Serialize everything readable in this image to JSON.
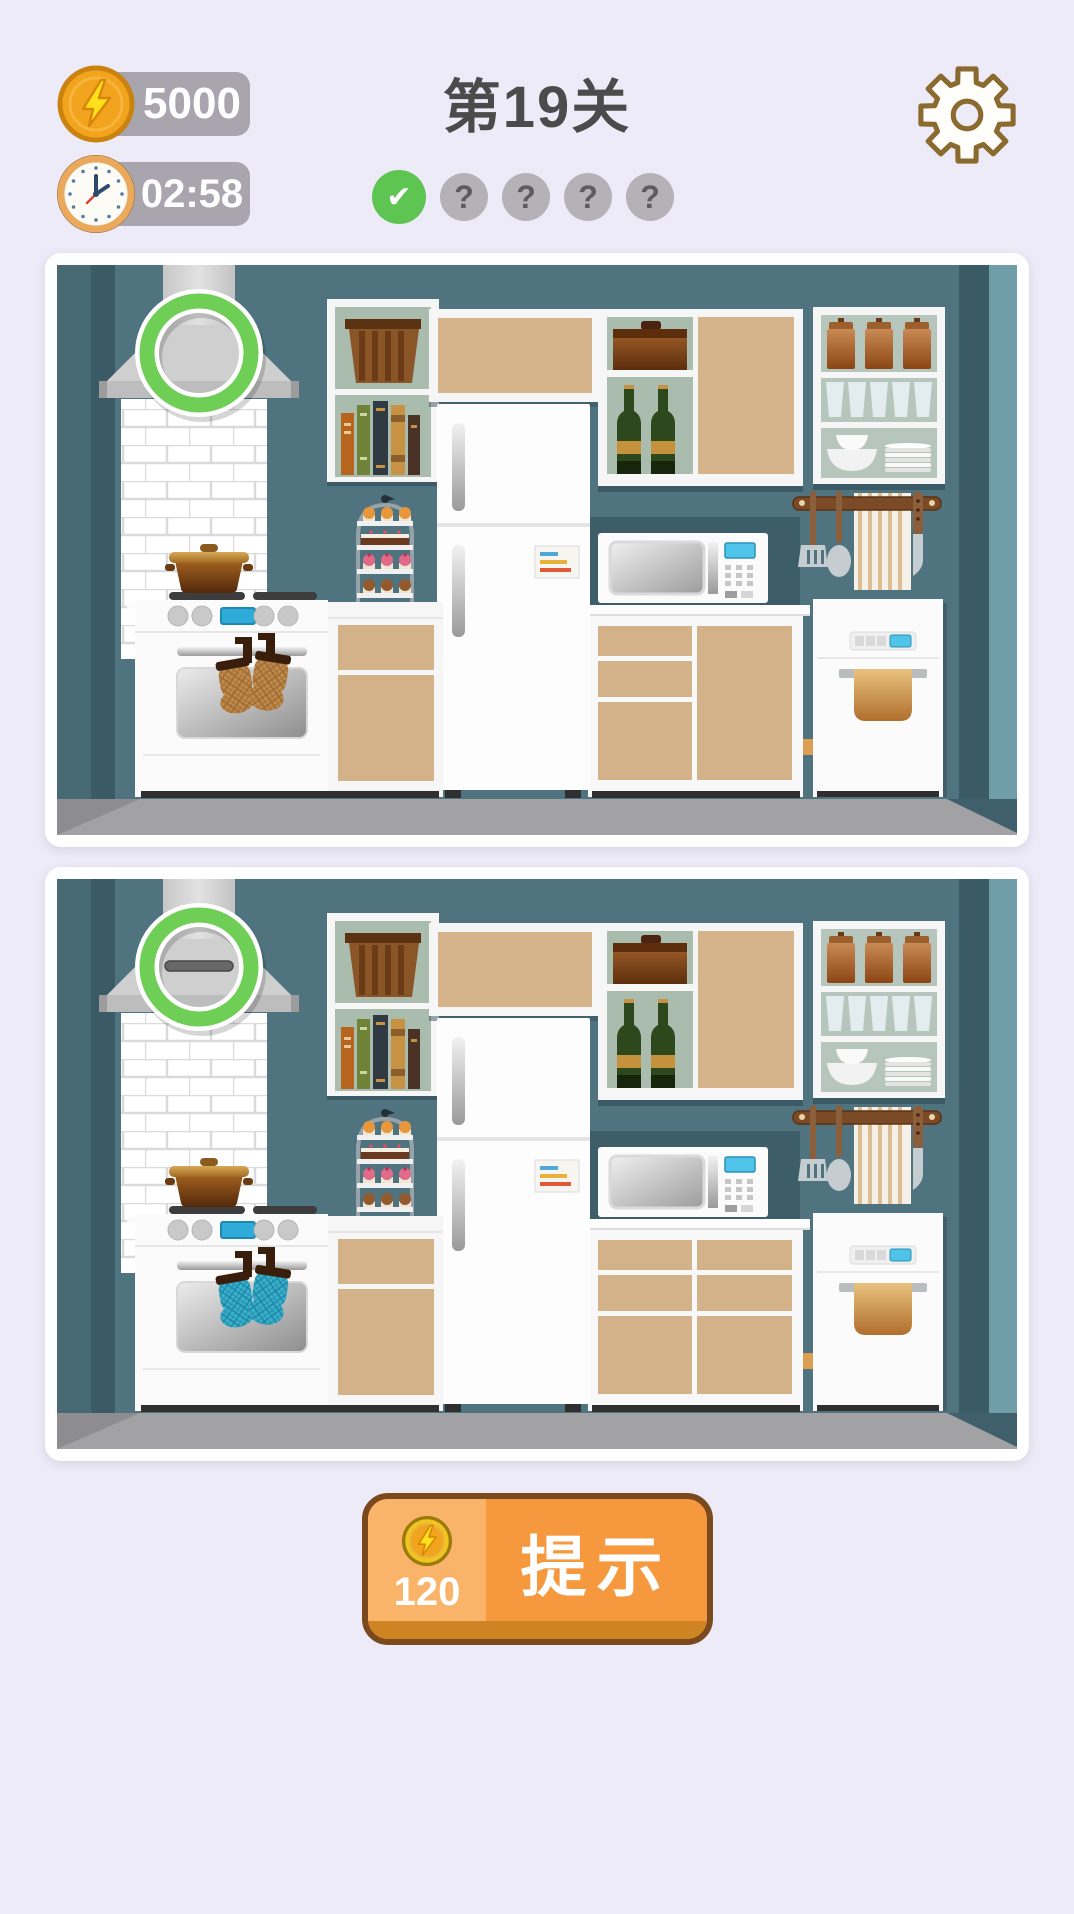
{
  "hud": {
    "coins": "5000",
    "timer": "02:58",
    "level_title": "第19关",
    "progress": {
      "found_icon": "✔",
      "unfound_icon": "?",
      "slots": [
        "found",
        "unfound",
        "unfound",
        "unfound",
        "unfound"
      ]
    }
  },
  "settings": {
    "icon": "gear-icon"
  },
  "panels": [
    {
      "name": "puzzle-image-top",
      "variant": "a",
      "found_marker": "range-hood-circled"
    },
    {
      "name": "puzzle-image-bottom",
      "variant": "b",
      "found_marker": "range-hood-circled"
    }
  ],
  "hint_button": {
    "label": "提示",
    "cost": "120",
    "icon": "coin-icon"
  },
  "colors": {
    "background": "#EDEBF7",
    "hud_pill": "#A9A5AE",
    "title_text": "#4B4B4B",
    "progress_found": "#5EC553",
    "progress_unfound": "#B4B1B7",
    "marker_green": "#6FCE55",
    "hint_fill": "#F6993E",
    "hint_fill_light": "#F9B469",
    "hint_strip": "#CE8423",
    "hint_border": "#7A4A1E",
    "wall_teal": "#4F737F",
    "mitt_variant_a": "#C08A4A",
    "mitt_variant_b": "#38B0CC"
  }
}
